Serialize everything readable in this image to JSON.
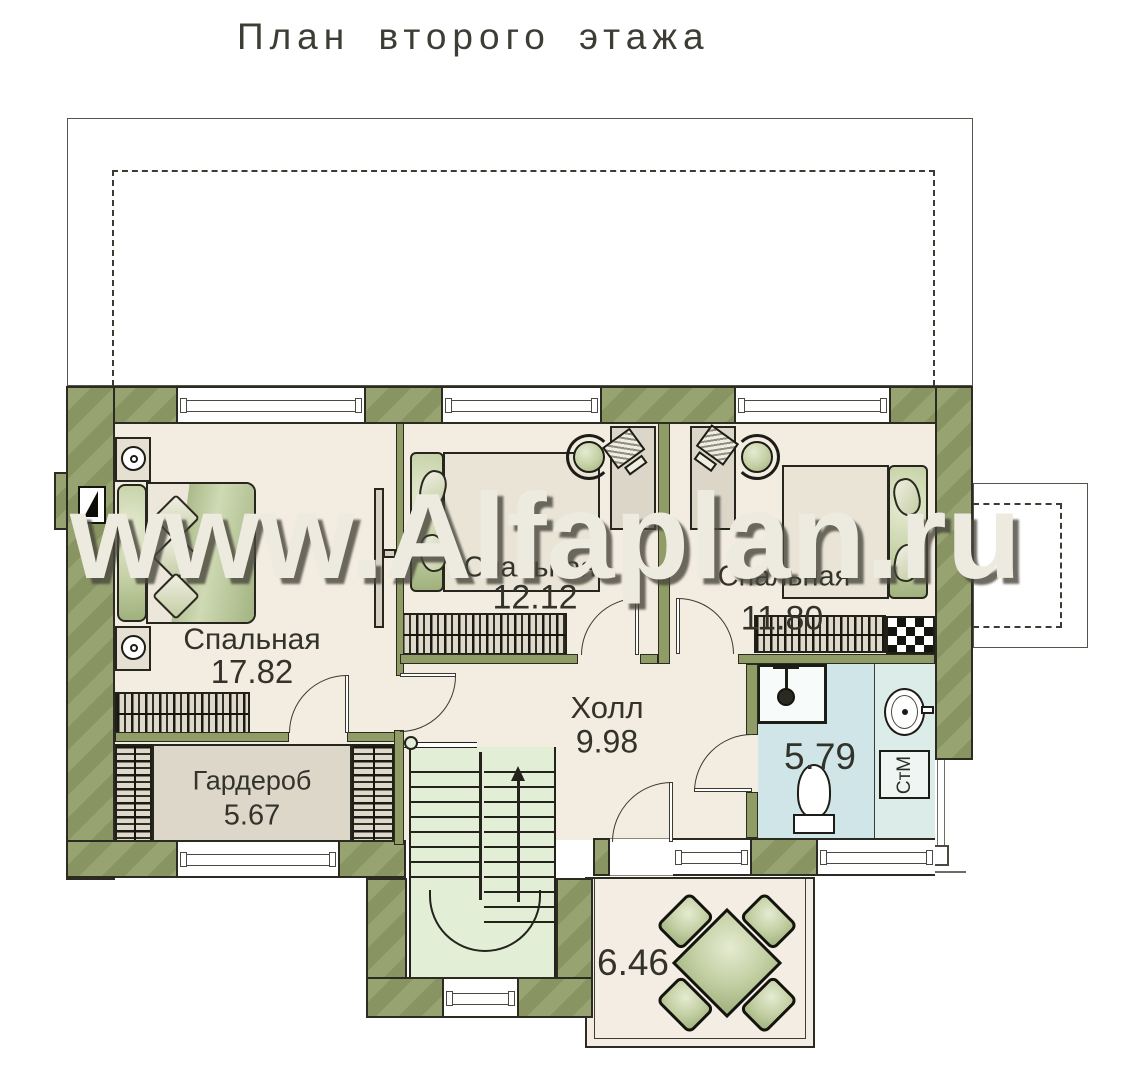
{
  "title": "План второго этажа",
  "watermark": "www.Alfaplan.ru",
  "rooms": {
    "bedroom1": {
      "name": "Спальная",
      "area": "17.82"
    },
    "bedroom2": {
      "name": "Спальная",
      "area": "12.12"
    },
    "bedroom3": {
      "name": "Спальная",
      "area": "11.80"
    },
    "hall": {
      "name": "Холл",
      "area": "9.98"
    },
    "wardrobe": {
      "name": "Гардероб",
      "area": "5.67"
    },
    "bathroom": {
      "area": "5.79"
    },
    "balcony": {
      "area": "6.46"
    }
  },
  "labels": {
    "washer": "СтМ"
  },
  "colors": {
    "wall": "#8f9c66",
    "floor": "#f2ece1",
    "bath": "#cfe5e7",
    "stairs": "#e2eed6",
    "furn": "#dcd6c8",
    "green1": "#9fb07c",
    "watermark": "#edeadf",
    "ink": "#33332b"
  }
}
